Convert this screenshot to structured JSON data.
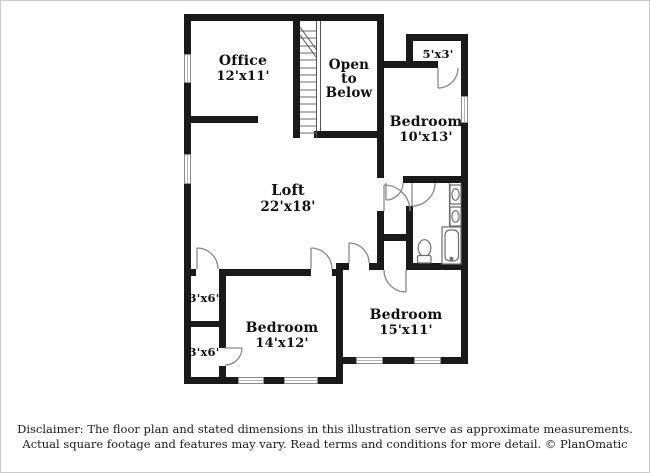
{
  "rooms": {
    "office": {
      "name": "Office",
      "dims": "12'x11'"
    },
    "open_to_below": {
      "line1": "Open",
      "line2": "to",
      "line3": "Below"
    },
    "closet_5x3": {
      "dims": "5'x3'"
    },
    "bedroom_10x13": {
      "name": "Bedroom",
      "dims": "10'x13'"
    },
    "loft": {
      "name": "Loft",
      "dims": "22'x18'"
    },
    "closet_3x6_upper": {
      "dims": "3'x6'"
    },
    "closet_3x6_lower": {
      "dims": "3'x6'"
    },
    "bedroom_14x12": {
      "name": "Bedroom",
      "dims": "14'x12'"
    },
    "bedroom_15x11": {
      "name": "Bedroom",
      "dims": "15'x11'"
    }
  },
  "footer": {
    "line1": "Disclaimer: The floor plan and stated dimensions in this illustration serve as approximate measurements.",
    "line2": "Actual square footage and features may vary. Read terms and conditions for more detail. © PlanOmatic"
  },
  "colors": {
    "wall": "#1a1a1a",
    "door_arc": "#8a8a8a",
    "window_frame": "#8c8c8c",
    "fixture": "#6e6e6e",
    "stair_line": "#6a6a6a",
    "text": "#101010",
    "page_border": "#c9c9c9"
  }
}
